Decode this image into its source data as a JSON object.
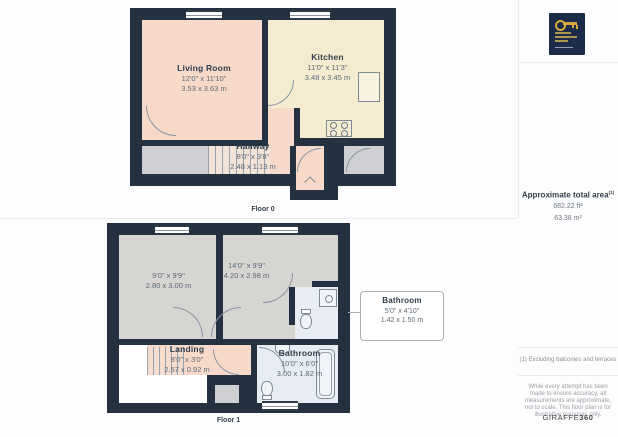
{
  "colors": {
    "wall": "#243140",
    "room_pink": "#f7d9ca",
    "room_cream": "#f4ebd1",
    "room_gray": "#d7d5d2",
    "room_blue": "#e8edf3",
    "outside_gray": "#cdcfd2",
    "logo_navy": "#1c2b49",
    "logo_gold": "#d7a93c"
  },
  "floor0": {
    "caption": "Floor 0",
    "living": {
      "name": "Living Room",
      "dims_ft": "12'0\" x 11'10\"",
      "dims_m": "3.53 x 3.63 m"
    },
    "kitchen": {
      "name": "Kitchen",
      "dims_ft": "11'0\" x 11'3\"",
      "dims_m": "3.48 x 3.45 m"
    },
    "hallway": {
      "name": "Hallway",
      "dims_ft": "8'0\" x 3'8\"",
      "dims_m": "2.48 x 1.13 m"
    }
  },
  "floor1": {
    "caption": "Floor 1",
    "bedroom1": {
      "dims_ft": "9'0\" x 9'9\"",
      "dims_m": "2.80 x 3.00 m"
    },
    "bedroom2": {
      "dims_ft": "14'0\" x 9'9\"",
      "dims_m": "4.20 x 2.98 m"
    },
    "landing": {
      "name": "Landing",
      "dims_ft": "8'0\" x 3'0\"",
      "dims_m": "2.57 x 0.92 m"
    },
    "bathroom": {
      "name": "Bathroom",
      "dims_ft": "10'0\" x 6'0\"",
      "dims_m": "3.00 x 1.82 m"
    }
  },
  "callout": {
    "name": "Bathroom",
    "dims_ft": "5'0\" x 4'10\"",
    "dims_m": "1.42 x 1.50 m"
  },
  "sidebar": {
    "area_title": "Approximate total area",
    "area_sup": "(1)",
    "area_ft": "682.22 ft²",
    "area_m": "63.38 m²",
    "footnote": "(1) Excluding balconies and terraces",
    "disclaimer": "While every attempt has been made to ensure accuracy, all measurements are approximate, not to scale. This floor plan is for illustrative purposes only.",
    "brand": "GIRAFFE",
    "brand_suffix": "360"
  }
}
